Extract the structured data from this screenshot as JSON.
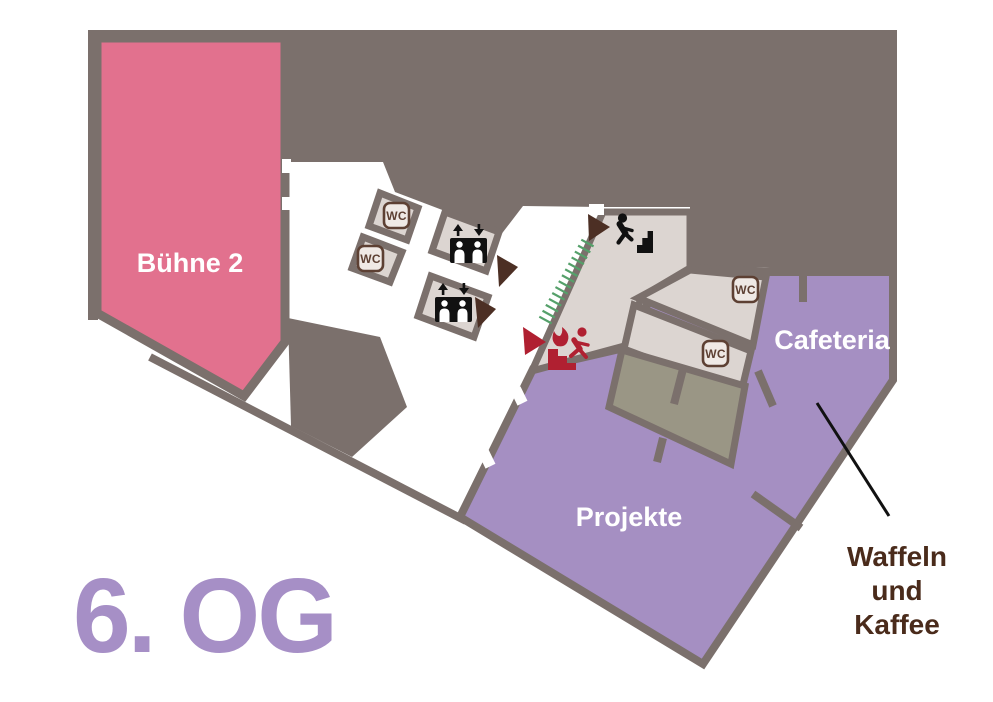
{
  "floor": {
    "title": "6. OG"
  },
  "areas": {
    "stage": {
      "label": "Bühne 2",
      "color": "#e2718e"
    },
    "cafeteria": {
      "label": "Cafeteria",
      "color": "#a58fc2"
    },
    "projects": {
      "label": "Projekte",
      "color": "#a58fc2"
    },
    "service_room_color": "#dcd5d1",
    "back_room_color": "#9a9685"
  },
  "annotation": {
    "line1": "Waffeln",
    "line2": "und",
    "line3": "Kaffee",
    "color": "#4a2b1b"
  },
  "icons": {
    "wc_label": "WC",
    "elevator": "elevator-icon",
    "stairs": "stairs-up-icon",
    "emergency_exit": "emergency-exit-running-person-icon",
    "direction_marker": "direction-triangle"
  },
  "colors": {
    "walls": "#7b706c",
    "background": "#ffffff",
    "stage_pink": "#e2718e",
    "area_purple": "#a58fc2",
    "room_beige": "#dcd5d1",
    "back_room_olive": "#9a9685",
    "icon_brown": "#5d4033",
    "triangle_brown": "#4c2f24",
    "emergency_red": "#b02031",
    "hatch_green": "#55a06a",
    "title_purple": "#a68fc6",
    "annotation_brown": "#4a2b1b"
  }
}
